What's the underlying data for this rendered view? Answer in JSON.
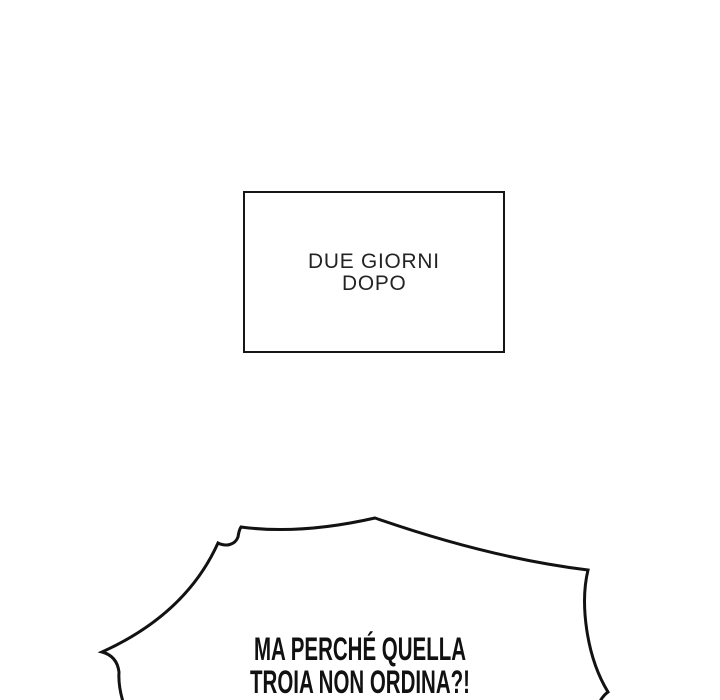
{
  "page": {
    "background": "#ffffff",
    "ink": "#121212"
  },
  "caption_box": {
    "line1": "DUE GIORNI",
    "line2": "DOPO"
  },
  "speech_bubble": {
    "line1": "MA PERCHÉ QUELLA",
    "line2": "TROIA NON ORDINA?!"
  }
}
